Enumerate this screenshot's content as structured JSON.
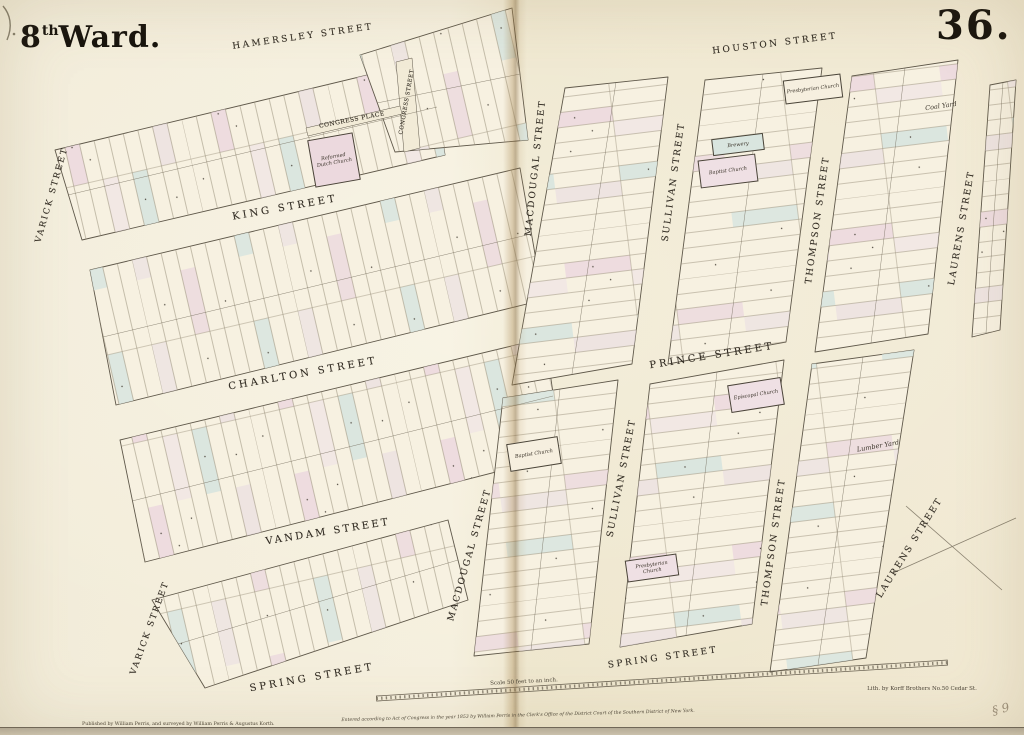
{
  "map": {
    "ward_title": {
      "number": "8",
      "suffix": "th",
      "word": "Ward."
    },
    "plate_number": "36.",
    "street_labels": [
      {
        "id": "hamersley",
        "label": "HAMERSLEY STREET"
      },
      {
        "id": "houston",
        "label": "HOUSTON STREET"
      },
      {
        "id": "king",
        "label": "KING STREET"
      },
      {
        "id": "charlton",
        "label": "CHARLTON STREET"
      },
      {
        "id": "vandam",
        "label": "VANDAM STREET"
      },
      {
        "id": "spring-west",
        "label": "SPRING STREET"
      },
      {
        "id": "spring-east",
        "label": "SPRING STREET"
      },
      {
        "id": "prince",
        "label": "PRINCE STREET"
      },
      {
        "id": "congress-place",
        "label": "CONGRESS PLACE"
      },
      {
        "id": "congress-street",
        "label": "CONGRESS STREET"
      },
      {
        "id": "varick-north",
        "label": "VARICK STREET"
      },
      {
        "id": "varick-south",
        "label": "VARICK STREET"
      },
      {
        "id": "macdougal-north",
        "label": "MACDOUGAL STREET"
      },
      {
        "id": "macdougal-south",
        "label": "MACDOUGAL STREET"
      },
      {
        "id": "sullivan-north",
        "label": "SULLIVAN STREET"
      },
      {
        "id": "sullivan-south",
        "label": "SULLIVAN STREET"
      },
      {
        "id": "thompson-north",
        "label": "THOMPSON STREET"
      },
      {
        "id": "thompson-south",
        "label": "THOMPSON STREET"
      },
      {
        "id": "laurens-north",
        "label": "LAURENS STREET"
      },
      {
        "id": "laurens-south",
        "label": "LAURENS STREET"
      }
    ],
    "building_labels": [
      {
        "id": "reformed-dutch-church",
        "line1": "Reformed",
        "line2": "Dutch Church"
      },
      {
        "id": "presbyterian-church-houston",
        "label": "Presbyterian Church"
      },
      {
        "id": "brewery",
        "label": "Brewery"
      },
      {
        "id": "baptist-church-houston",
        "label": "Baptist Church"
      },
      {
        "id": "coal-yard",
        "label": "Coal Yard"
      },
      {
        "id": "episcopal-church",
        "label": "Episcopal Church"
      },
      {
        "id": "baptist-church-macdougal",
        "label": "Baptist Church"
      },
      {
        "id": "presbyterian-church-spring",
        "label": "Presbyterian Church"
      },
      {
        "id": "lumber-yard",
        "label": "Lumber Yard"
      }
    ],
    "scale": {
      "label": "Scale 50 feet to an inch."
    },
    "imprints": {
      "copyright": "Entered according to Act of Congress in the year 1853 by William Perris in the Clerk's Office of the District Court of the Southern District of New York.",
      "publisher": "Published by William Perris, and surveyed by William Perris & Augustus Korth.",
      "lithographer": "Lith. by Korff Brothers No.50 Cedar St."
    },
    "handwritten_mark": "§ 9",
    "colors": {
      "paper": "#f2ebd7",
      "block_fill": "#f7f1e1",
      "lot_line": "#9b927d",
      "block_outline": "#5f584a",
      "tint_pink": "#ecd9de",
      "tint_blue": "#d9e5df",
      "ink": "#332d24",
      "fold_crease": "#a98954"
    }
  }
}
